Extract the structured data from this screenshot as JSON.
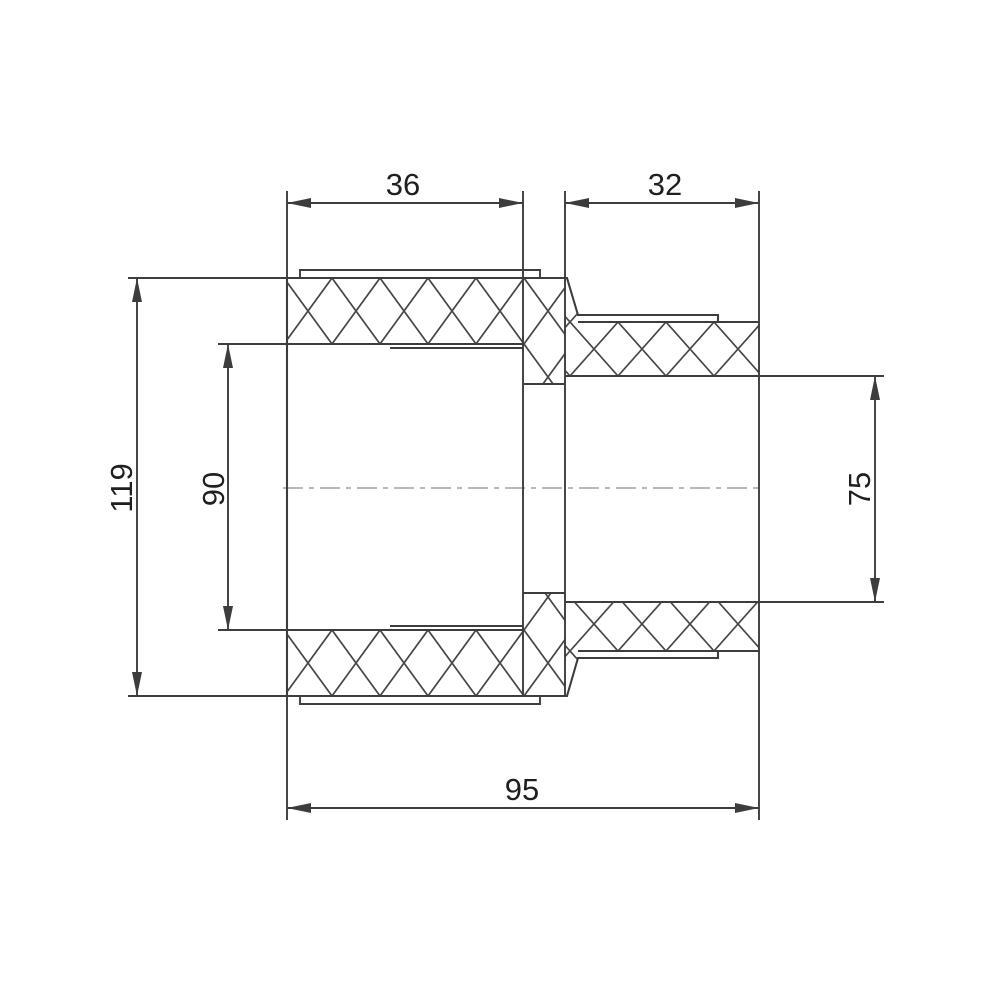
{
  "drawing": {
    "depicts": "threaded-reducing-adapter-cross-section"
  },
  "dimensions": {
    "left_thread_length": "36",
    "right_thread_length": "32",
    "overall_height": "119",
    "left_bore": "90",
    "right_bore": "75",
    "overall_length": "95"
  },
  "colors": {
    "line": "#3d3d3d",
    "hatch": "#474747",
    "text": "#1f1f1f",
    "centerline": "#b8b8b8",
    "background": "#ffffff"
  }
}
